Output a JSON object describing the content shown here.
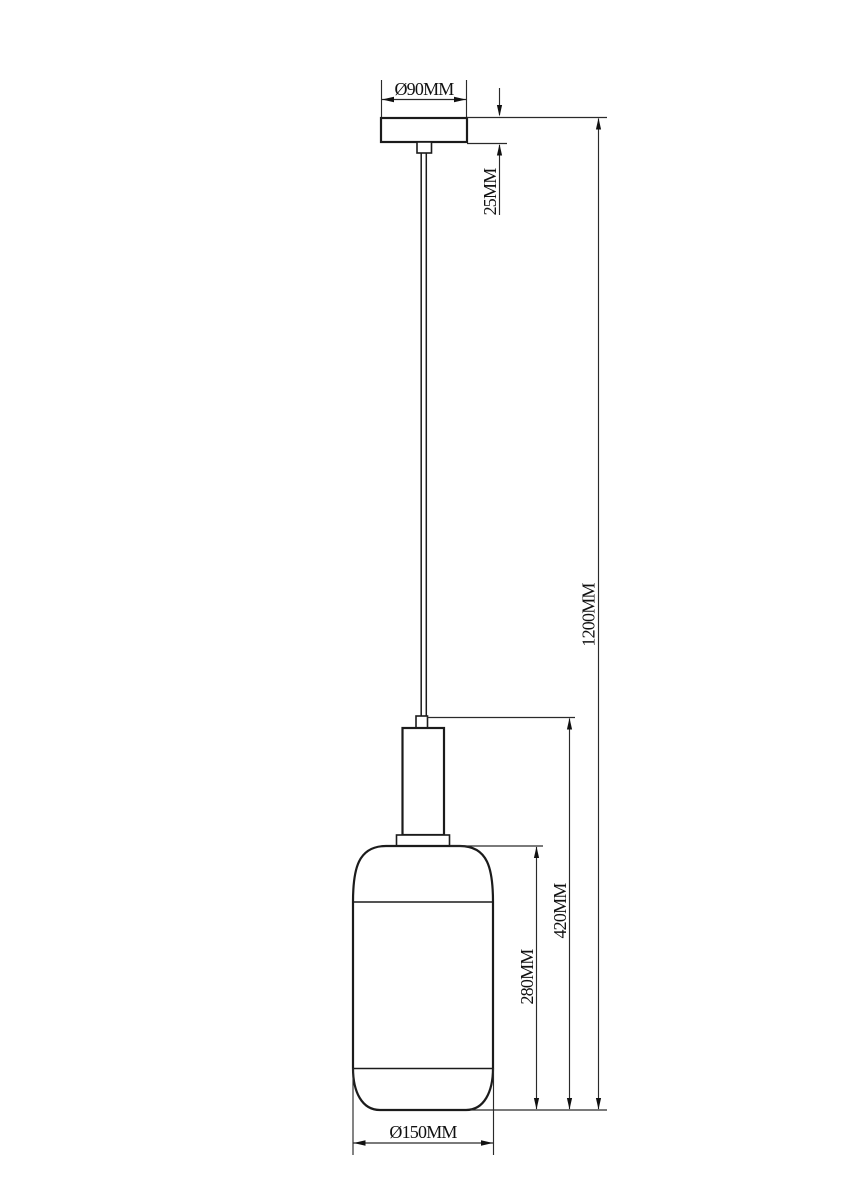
{
  "drawing": {
    "background_color": "#ffffff",
    "line_color": "#1b1b1b",
    "dimension_text_color": "#111111",
    "dimensions": {
      "canopy_diameter": "Ø90MM",
      "canopy_height": "25MM",
      "overall_height": "1200MM",
      "fixture_height": "420MM",
      "shade_height": "280MM",
      "shade_diameter": "Ø150MM"
    }
  }
}
